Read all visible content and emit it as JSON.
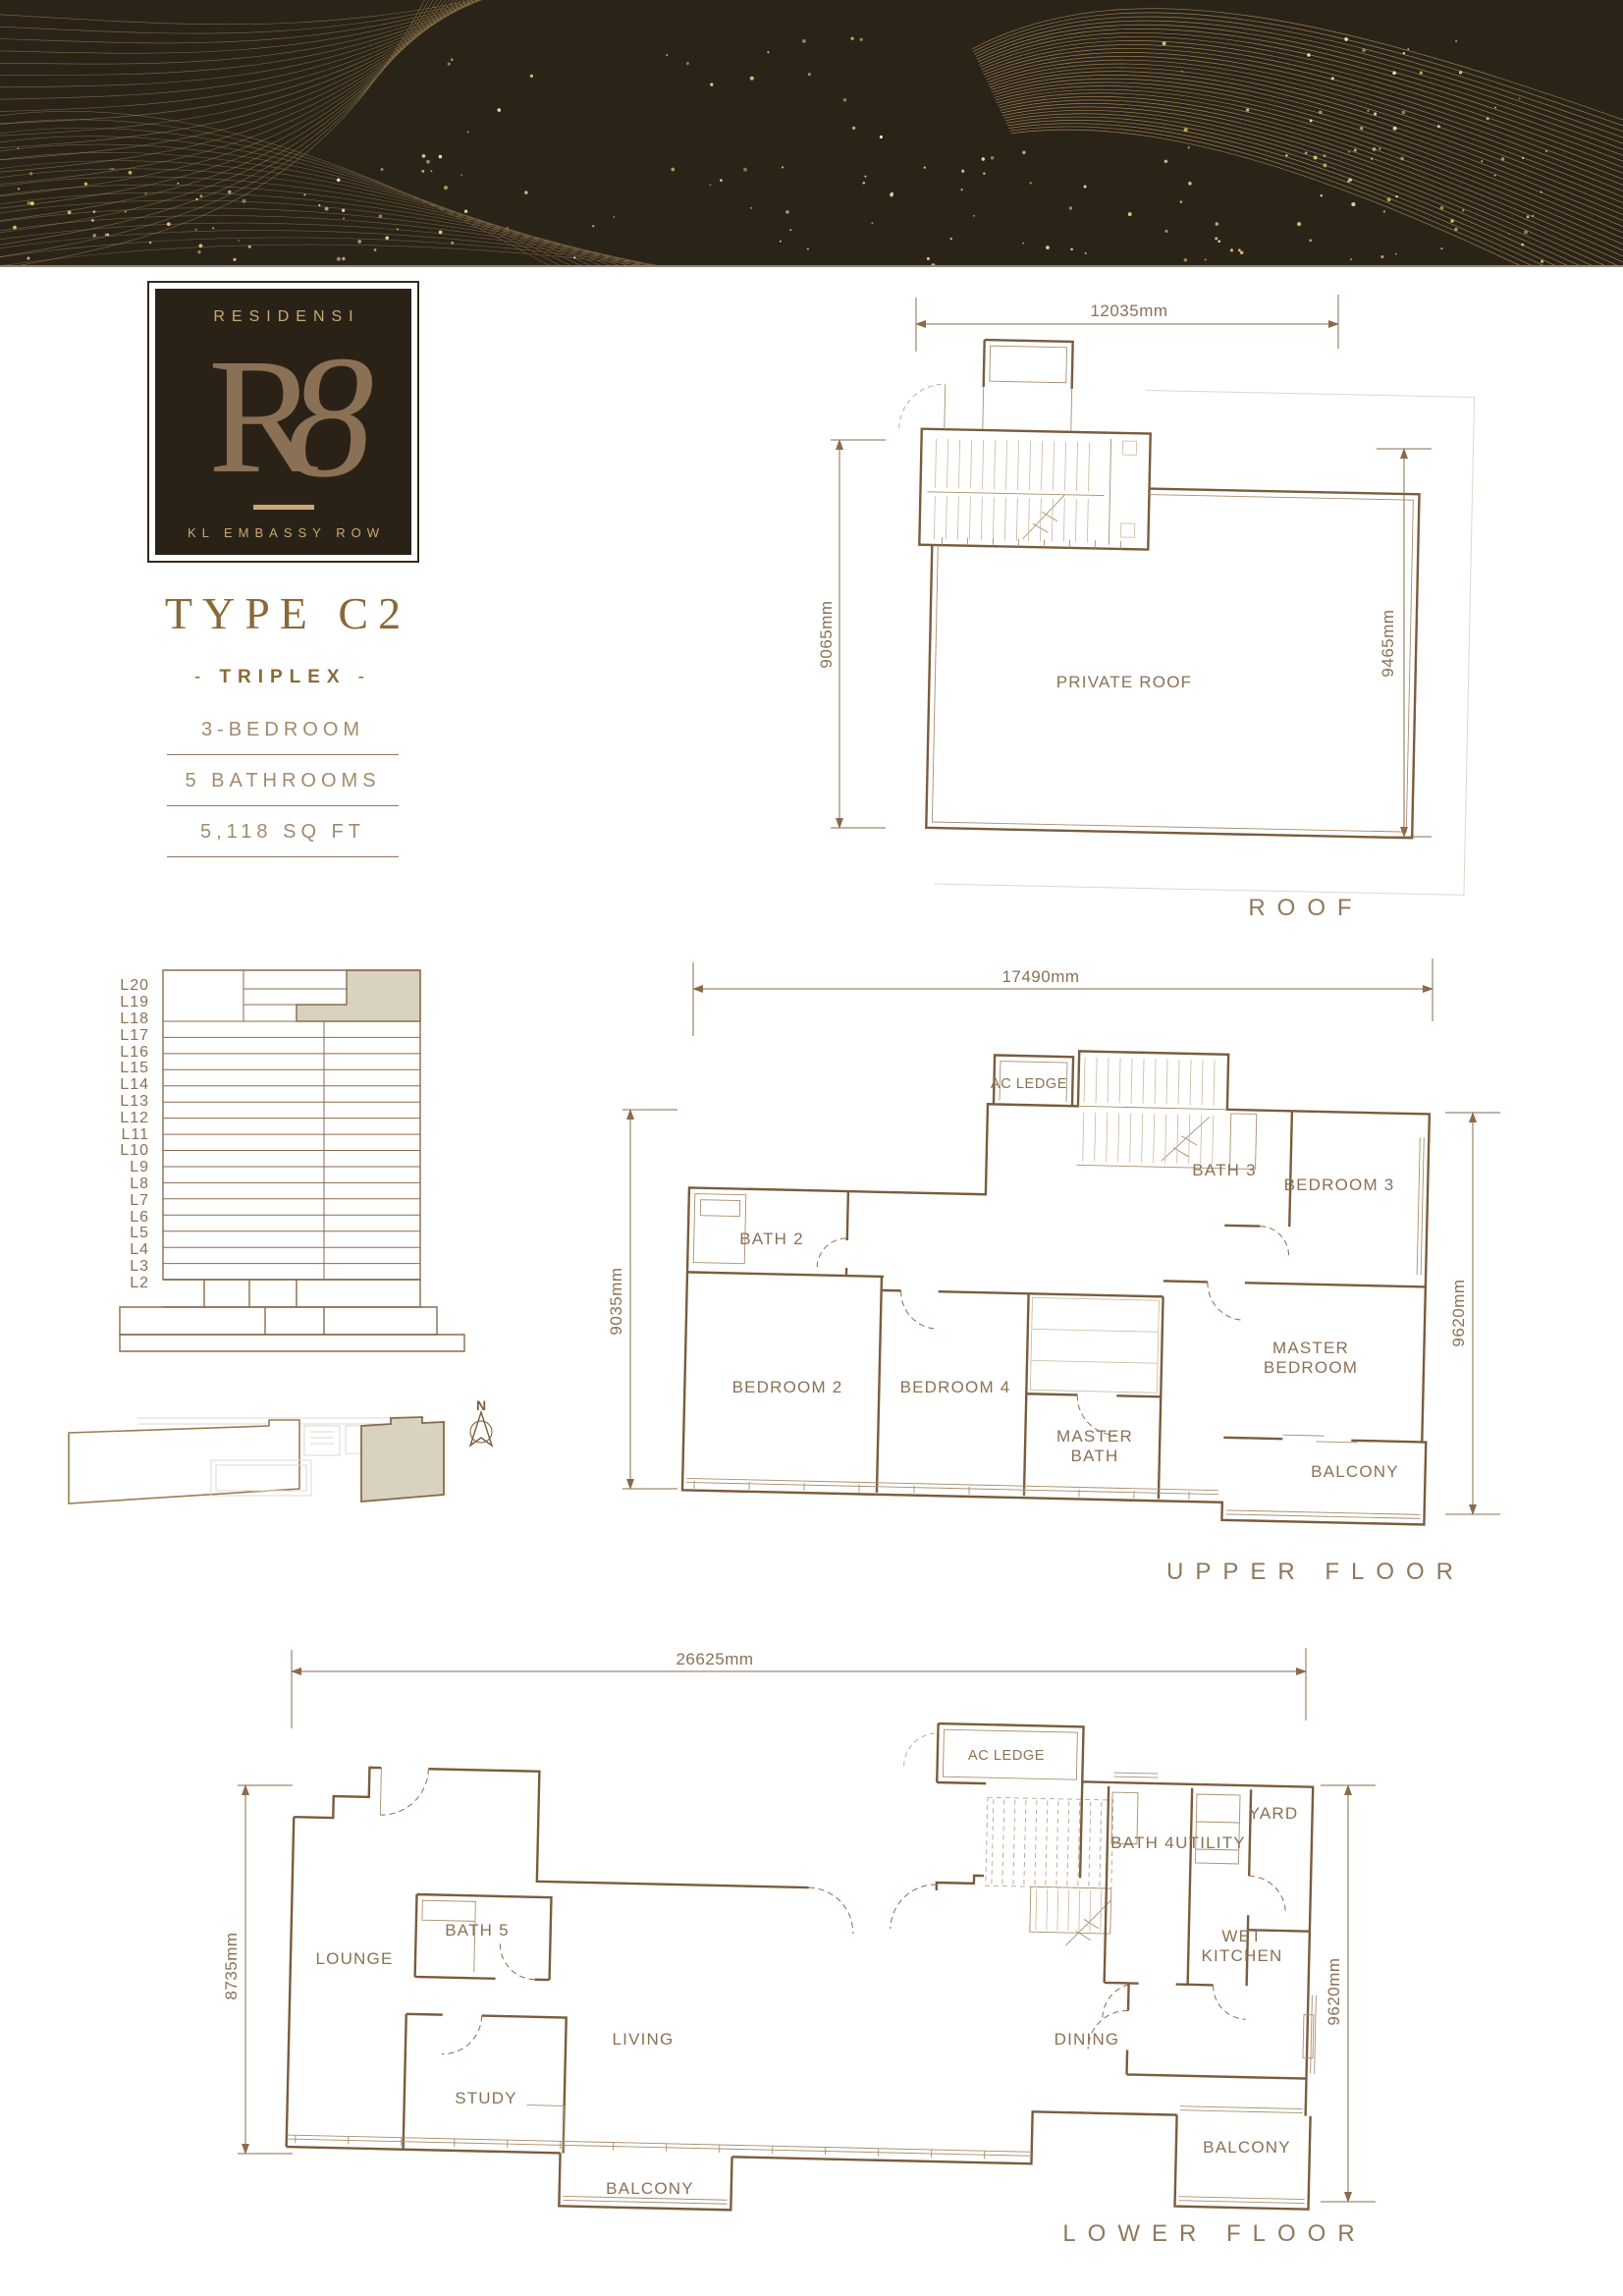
{
  "banner": {
    "bg": "#2a2318",
    "line_gold": "#b99763",
    "dot_gold": "#e0c671",
    "dot_pale": "#efe6b8",
    "edge": "#8d867a"
  },
  "logo": {
    "brand_top": "RESIDENSI",
    "brand_mark_r": "R",
    "brand_mark_8": "8",
    "brand_bottom": "KL EMBASSY ROW",
    "gold": "#c9a877",
    "gradient_from": "#ecc490",
    "gradient_mid": "#c99a5f",
    "gradient_to": "#8f6f45"
  },
  "unit": {
    "type_label": "TYPE C2",
    "subtype_prefix": "-",
    "subtype": "TRIPLEX",
    "subtype_suffix": "-",
    "specs": [
      "3-BEDROOM",
      "5 BATHROOMS",
      "5,118 SQ FT"
    ]
  },
  "stack": {
    "levels": [
      "L20",
      "L19",
      "L18",
      "L17",
      "L16",
      "L15",
      "L14",
      "L13",
      "L12",
      "L11",
      "L10",
      "L9",
      "L8",
      "L7",
      "L6",
      "L5",
      "L4",
      "L3",
      "L2"
    ],
    "highlight": "#d9d2c1"
  },
  "north": {
    "label": "N"
  },
  "key_plan": {
    "highlight": "#d9d2c1"
  },
  "floors": {
    "roof": {
      "title": "ROOF",
      "dims": {
        "top": "12035mm",
        "left": "9065mm",
        "right": "9465mm"
      },
      "rooms": [
        {
          "label": "PRIVATE ROOF"
        }
      ]
    },
    "upper": {
      "title": "UPPER FLOOR",
      "dims": {
        "top": "17490mm",
        "left": "9035mm",
        "right": "9620mm"
      },
      "rooms": [
        {
          "label": "AC LEDGE"
        },
        {
          "label": "BATH 2"
        },
        {
          "label": "BATH 3"
        },
        {
          "label": "BEDROOM 3"
        },
        {
          "label": "BEDROOM 2"
        },
        {
          "label": "BEDROOM 4"
        },
        {
          "lines": [
            "MASTER",
            "BATH"
          ]
        },
        {
          "lines": [
            "MASTER",
            "BEDROOM"
          ]
        },
        {
          "label": "BALCONY"
        }
      ]
    },
    "lower": {
      "title": "LOWER FLOOR",
      "dims": {
        "top": "26625mm",
        "left": "8735mm",
        "right": "9620mm"
      },
      "rooms": [
        {
          "label": "AC LEDGE"
        },
        {
          "label": "BATH 4"
        },
        {
          "label": "UTILITY"
        },
        {
          "label": "YARD"
        },
        {
          "lines": [
            "WET",
            "KITCHEN"
          ]
        },
        {
          "label": "LOUNGE"
        },
        {
          "label": "BATH 5"
        },
        {
          "label": "STUDY"
        },
        {
          "label": "LIVING"
        },
        {
          "label": "DINING"
        },
        {
          "label": "BALCONY"
        },
        {
          "label": "BALCONY"
        }
      ]
    }
  }
}
